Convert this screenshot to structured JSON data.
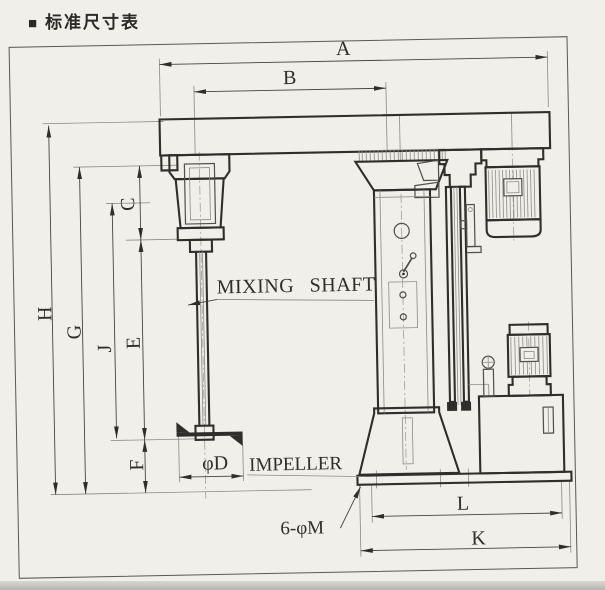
{
  "header": {
    "bullet": "■",
    "title": "标准尺寸表"
  },
  "diagram": {
    "dims": {
      "A": "A",
      "B": "B",
      "C": "C",
      "D": "φD",
      "E": "E",
      "F": "F",
      "G": "G",
      "H": "H",
      "J": "J",
      "K": "K",
      "L": "L",
      "M": "6-φM"
    },
    "labels": {
      "mixing_shaft": "MIXING SHAFT",
      "impeller": "IMPELLER"
    },
    "colors": {
      "paper": "#f1efe9",
      "ink": "#2f2e2c",
      "thin_line": "#8c8a84",
      "dim_line": "#45443f"
    }
  }
}
